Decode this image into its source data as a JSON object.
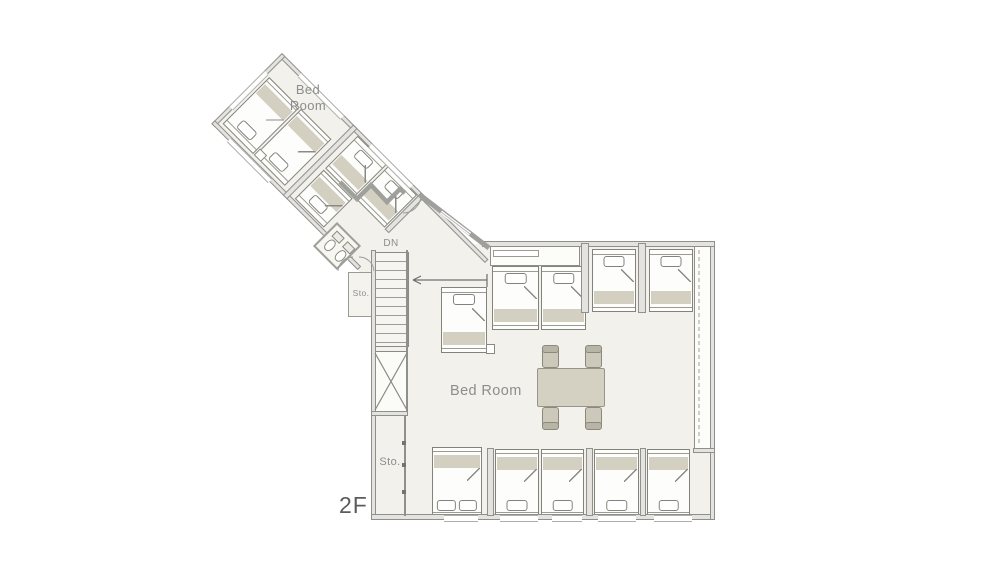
{
  "labels": {
    "wing_bedroom": "Bed\nRoom",
    "stairs_dn": "DN",
    "storage_small": "Sto.",
    "storage_main": "Sto.",
    "bedroom_main": "Bed Room",
    "floor_level": "2F"
  },
  "colors": {
    "floor": "#f2f1ec",
    "wall": "#8f8f8b",
    "bed_band": "#d3d0c2",
    "furniture": "#ccc9bb",
    "label_text": "#8d8d8d",
    "floor_label_text": "#5c5c5c",
    "background": "#ffffff"
  },
  "furniture": {
    "beds": [
      {
        "c": "page",
        "x": 441,
        "y": 287,
        "w": 46,
        "h": 66,
        "dir": "up",
        "type": "single"
      },
      {
        "c": "page",
        "x": 492,
        "y": 266,
        "w": 47,
        "h": 64,
        "dir": "up",
        "type": "single"
      },
      {
        "c": "page",
        "x": 541,
        "y": 266,
        "w": 45,
        "h": 64,
        "dir": "up",
        "type": "single"
      },
      {
        "c": "page",
        "x": 592,
        "y": 249,
        "w": 44,
        "h": 63,
        "dir": "up",
        "type": "single"
      },
      {
        "c": "page",
        "x": 649,
        "y": 249,
        "w": 44,
        "h": 63,
        "dir": "up",
        "type": "single"
      },
      {
        "c": "page",
        "x": 432,
        "y": 447,
        "w": 50,
        "h": 71,
        "dir": "down",
        "type": "double"
      },
      {
        "c": "page",
        "x": 495,
        "y": 449,
        "w": 44,
        "h": 69,
        "dir": "down",
        "type": "single"
      },
      {
        "c": "page",
        "x": 541,
        "y": 449,
        "w": 43,
        "h": 69,
        "dir": "down",
        "type": "single"
      },
      {
        "c": "page",
        "x": 594,
        "y": 449,
        "w": 45,
        "h": 69,
        "dir": "down",
        "type": "single"
      },
      {
        "c": "page",
        "x": 647,
        "y": 449,
        "w": 43,
        "h": 69,
        "dir": "down",
        "type": "single"
      },
      {
        "c": "wing",
        "x": 8,
        "y": 26,
        "w": 43,
        "h": 66,
        "dir": "down",
        "type": "single"
      },
      {
        "c": "wing",
        "x": 53,
        "y": 26,
        "w": 43,
        "h": 66,
        "dir": "down",
        "type": "single"
      },
      {
        "c": "wing",
        "x": 112,
        "y": 5,
        "w": 41,
        "h": 46,
        "dir": "up",
        "type": "single"
      },
      {
        "c": "wing",
        "x": 155,
        "y": 5,
        "w": 41,
        "h": 46,
        "dir": "up",
        "type": "single"
      },
      {
        "c": "wing",
        "x": 112,
        "y": 53,
        "w": 41,
        "h": 41,
        "dir": "down",
        "type": "single"
      }
    ],
    "table": {
      "x": 537,
      "y": 368,
      "w": 68,
      "h": 39
    },
    "chairs": [
      {
        "x": 542,
        "y": 346,
        "w": 17,
        "h": 22,
        "back": "top"
      },
      {
        "x": 585,
        "y": 346,
        "w": 17,
        "h": 22,
        "back": "top"
      },
      {
        "x": 542,
        "y": 407,
        "w": 17,
        "h": 22,
        "back": "bottom"
      },
      {
        "x": 585,
        "y": 407,
        "w": 17,
        "h": 22,
        "back": "bottom"
      }
    ],
    "nightstands": [
      {
        "c": "page",
        "x": 486,
        "y": 344,
        "w": 9,
        "h": 10
      },
      {
        "c": "wing",
        "x": 52,
        "y": 83,
        "w": 10,
        "h": 9
      }
    ],
    "toilets": [
      {
        "x": 4,
        "y": 4
      },
      {
        "x": 19,
        "y": 4
      }
    ]
  }
}
